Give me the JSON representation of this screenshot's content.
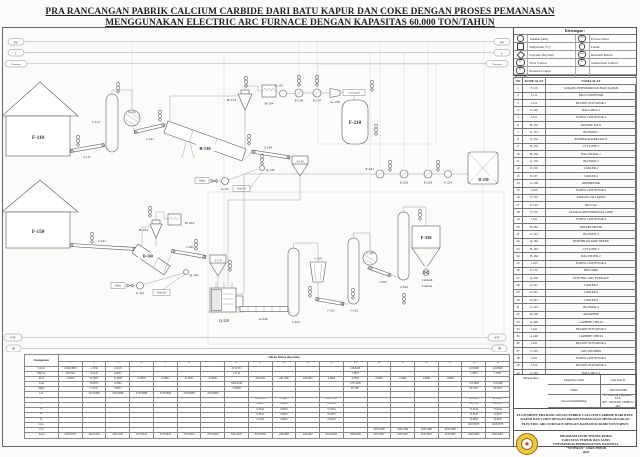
{
  "title": {
    "line1": "PRA RANCANGAN PABRIK CALCIUM CARBIDE DARI BATU KAPUR DAN COKE DENGAN PROSES PEMANASAN",
    "line2": "MENGGUNAKAN ELECTRIC ARC FURNACE DENGAN KAPASITAS 60.000 TON/TAHUN"
  },
  "colors": {
    "paper": "#fbfbfa",
    "line": "#555555",
    "logo_yellow": "#f3c63a",
    "logo_red": "#c23b2a"
  },
  "legend": {
    "title": "Keterangan :",
    "rows": [
      {
        "left_symbol": "circle",
        "left_label": "Tekanan (atm)",
        "right_code": "PW",
        "right_label": "Process Water"
      },
      {
        "left_symbol": "square",
        "left_label": "Temperatur (°C)",
        "right_code": "L",
        "right_label": "Listrik"
      },
      {
        "left_symbol": "diamond",
        "left_label": "Laju Alir (Kg/Jam)",
        "right_code": "DR",
        "right_label": "Dowterm Return"
      },
      {
        "left_code": "FC",
        "left_label": "Flow Control",
        "right_code": "TC",
        "right_label": "Temperature Control"
      },
      {
        "left_code": "PC",
        "left_label": "Pressure Control",
        "right_code": "",
        "right_label": ""
      },
      {
        "left_code": "WTP",
        "left_label": "Water Treatment Process",
        "right_code": "",
        "right_label": ""
      }
    ]
  },
  "equipment_table": {
    "headers": [
      "NO",
      "KODE ALAT",
      "NAMA ALAT"
    ],
    "rows": [
      [
        "1",
        "F-110",
        "GUDANG PENYIMPANAN BATU KAPUR"
      ],
      [
        "2",
        "J-111",
        "BELT CONVEYOR"
      ],
      [
        "3",
        "J-112",
        "BUCKET ELEVATOR-1"
      ],
      [
        "4",
        "C-120",
        "BALL MILL-1"
      ],
      [
        "5",
        "J-121",
        "SCREW CONVEYOR-1"
      ],
      [
        "6",
        "B-130",
        "ROTARY KILN"
      ],
      [
        "7",
        "G-131",
        "BLOWER-1"
      ],
      [
        "8",
        "Q-132",
        "BURNER ROTARY KILN"
      ],
      [
        "9",
        "H-133",
        "CYCLONE-1"
      ],
      [
        "10",
        "H-134",
        "BAG FILTER-1"
      ],
      [
        "11",
        "G-135",
        "BLOWER-2"
      ],
      [
        "12",
        "E-136",
        "COOLER-1"
      ],
      [
        "13",
        "E-137",
        "COOLER-2"
      ],
      [
        "14",
        "G-138",
        "KOMPRESOR"
      ],
      [
        "15",
        "J-139",
        "SCREW CONVEYOR-2"
      ],
      [
        "16",
        "F-210",
        "TANGKI CO2 LIQUID"
      ],
      [
        "17",
        "F-140",
        "BIN CaO"
      ],
      [
        "18",
        "F-150",
        "GUDANG PENYIMPANAN COKE"
      ],
      [
        "19",
        "J-141",
        "SCREW CONVEYOR-3"
      ],
      [
        "20",
        "B-160",
        "ROTARY DRYER"
      ],
      [
        "21",
        "G-161",
        "BLOWER-3"
      ],
      [
        "22",
        "Q-162",
        "BURNER ROTARY DRYER"
      ],
      [
        "23",
        "H-163",
        "CYCLONE-2"
      ],
      [
        "24",
        "H-164",
        "BAG FILTER-2"
      ],
      [
        "25",
        "J-165",
        "SCREW CONVEYOR-4"
      ],
      [
        "26",
        "F-170",
        "BIN COKE"
      ],
      [
        "27",
        "Q-220",
        "ELECTRIC ARC FURNACE"
      ],
      [
        "28",
        "E-221",
        "COOLER-3"
      ],
      [
        "29",
        "E-222",
        "COOLER-4"
      ],
      [
        "30",
        "E-223",
        "COOLER-5"
      ],
      [
        "31",
        "G-224",
        "BLOWER-4"
      ],
      [
        "32",
        "D-230",
        "ABSORBER"
      ],
      [
        "33",
        "A-240",
        "CARBIDE CHILLS"
      ],
      [
        "34",
        "J-241",
        "BUCKET ELEVATOR-2"
      ],
      [
        "35",
        "A-240",
        "CARBIDE CHILLS"
      ],
      [
        "36",
        "J-241",
        "BUCKET ELEVATOR-2"
      ],
      [
        "37",
        "C-310",
        "JAW CRUSHER"
      ],
      [
        "38",
        "J-311",
        "SCREW CONVEYOR-5"
      ],
      [
        "39",
        "J-312",
        "BUCKET ELEVATOR-3"
      ],
      [
        "40",
        "C-320",
        "BALL MILL-2"
      ],
      [
        "41",
        "J-321",
        "SCREW CONVEYOR-6"
      ],
      [
        "42",
        "J-322",
        "BUCKET ELEVATOR-4"
      ],
      [
        "43",
        "F-330",
        "SILO PENYIMPANAN CaC2"
      ]
    ]
  },
  "title_block": {
    "digambar_label": "Digambar Oleh",
    "digambar_value": "Ade Nandy",
    "mengetahui": "Mengetahui",
    "npm_label": "NPM",
    "npm_value": "20031010088",
    "dosen_label": "Dosen Pembimbing",
    "dosen_value": "Ir. Caecilia Pujiastuti, M.T.",
    "dosen_nip": "NIP. 19630305 198803 2 001",
    "flowsheet_caption": "FLOWSHEET PRA RANCANGAN PABRIK CALCIUM CARBIDE DARI BATU KAPUR DAN COKE DENGAN PROSES PEMANASAN MENGGUNAKAN ELECTRIC ARC FURNACE DENGAN KAPASITAS 60.000 TON/TAHUN",
    "institution": {
      "line1": "PROGRAM STUDI TEKNIK KIMIA",
      "line2": "FAKULTAS TEKNIK DAN SAINS",
      "line3": "UNIVERSITAS PEMBANGUNAN NASIONAL",
      "line4": "\"VETERAN\" JAWA TIMUR",
      "line5": "2023"
    }
  },
  "stream_table": {
    "corner_header": "Komponen",
    "title": "Aliran Massa (Kg/Jam)",
    "columns": [
      "1",
      "2",
      "3",
      "4",
      "5",
      "6",
      "7",
      "8",
      "9",
      "10",
      "11",
      "12",
      "13",
      "14",
      "15",
      "16",
      "17",
      "18",
      "19"
    ],
    "rows": [
      {
        "name": "CaCO₃",
        "values": [
          "10966.7858",
          "2.1939",
          "0.8218",
          "",
          "",
          "",
          "",
          "213.9131",
          "",
          "",
          "",
          "",
          "218.8948",
          "",
          "",
          "",
          "",
          "218.8948",
          "218.8948"
        ]
      },
      {
        "name": "MgCO₃",
        "values": [
          "89.2744",
          "0.8129",
          "0.0003",
          "",
          "",
          "",
          "",
          "1.3714",
          "",
          "",
          "",
          "",
          "1.3853",
          "",
          "",
          "",
          "",
          "1.3853",
          "1.3853"
        ]
      },
      {
        "name": "H₂O",
        "values": [
          "21.9935",
          "21.9935",
          "21.9935",
          "21.9935",
          "21.9935",
          "21.9935",
          "21.9935",
          "",
          "246.1945",
          "246.1940",
          "246.1940",
          "2.0909",
          "2.0909",
          "2.0909",
          "2.0909",
          "2.0909",
          "2.0909",
          "",
          ""
        ]
      },
      {
        "name": "CaO",
        "values": [
          "",
          "59.2670",
          "4.7984",
          "",
          "",
          "",
          "",
          "5924.6549",
          "",
          "",
          "",
          "",
          "7181.1608",
          "",
          "",
          "",
          "",
          "718.1608",
          "718.1608"
        ]
      },
      {
        "name": "MgO",
        "values": [
          "",
          "0.3233",
          "0.0013",
          "",
          "",
          "",
          "",
          "51.0843",
          "",
          "",
          "",
          "",
          "93.3281",
          "",
          "",
          "",
          "",
          "93.3281",
          "93.3281"
        ]
      },
      {
        "name": "CO₂",
        "values": [
          "",
          "4733.6688",
          "4733.6688",
          "4733.6688",
          "4733.6688",
          "4733.6688",
          "4733.6688",
          "",
          "",
          "",
          "",
          "",
          "",
          "",
          "",
          "",
          "",
          "",
          ""
        ]
      },
      {
        "name": "C",
        "values": [
          "",
          "",
          "",
          "",
          "",
          "",
          "",
          "",
          "5858.4718",
          "0.3847",
          "",
          "5847.1783",
          "",
          "",
          "",
          "",
          "",
          "603.8633",
          "603.8633"
        ]
      },
      {
        "name": "S",
        "values": [
          "",
          "",
          "",
          "",
          "",
          "",
          "",
          "",
          "6.2927",
          "0.0029",
          "",
          "29.2728",
          "",
          "",
          "",
          "",
          "",
          "29.2728",
          "29.2728"
        ]
      },
      {
        "name": "H₂",
        "values": [
          "",
          "",
          "",
          "",
          "",
          "",
          "",
          "",
          "9.3344",
          "0.0034",
          "",
          "57.6534",
          "",
          "",
          "",
          "",
          "",
          "57.6534",
          "57.6534"
        ]
      },
      {
        "name": "O₂",
        "values": [
          "",
          "",
          "",
          "",
          "",
          "",
          "",
          "",
          "9.3341",
          "0.0033",
          "",
          "55.6537",
          "",
          "",
          "",
          "",
          "",
          "55.6537",
          "55.6537"
        ]
      },
      {
        "name": "N₂",
        "values": [
          "",
          "",
          "",
          "",
          "",
          "",
          "",
          "",
          "6.2109",
          "0.0023",
          "",
          "23.0903",
          "",
          "",
          "",
          "",
          "",
          "23.0903",
          "23.0903"
        ]
      },
      {
        "name": "CaC₂",
        "values": [
          "",
          "",
          "",
          "",
          "",
          "",
          "",
          "",
          "",
          "",
          "",
          "",
          "",
          "",
          "",
          "",
          "",
          "6618.6978",
          "6618.6978"
        ]
      },
      {
        "name": "CO",
        "values": [
          "",
          "",
          "",
          "",
          "",
          "",
          "",
          "",
          "",
          "",
          "",
          "",
          "",
          "2433.1898",
          "2433.1898",
          "2433.1898",
          "2433.1898",
          "",
          ""
        ]
      },
      {
        "name": "Total",
        "values": [
          "11078.0537",
          "4818.2594",
          "4761.2841",
          "4755.6623",
          "4755.6623",
          "4755.6623",
          "4755.6623",
          "6191.0237",
          "6135.8384",
          "246.5906",
          "246.1940",
          "6014.9394",
          "7496.8599",
          "2435.2807",
          "2435.2807",
          "2435.2807",
          "2435.2807",
          "8420.0003",
          "8420.0003"
        ]
      }
    ]
  },
  "diagram": {
    "utilities": {
      "pw": "PW",
      "listrik": "L",
      "dowterm": "Dowterm",
      "wtp": "WTP",
      "dr": "DR"
    },
    "annotations": {
      "udara": "Udara",
      "fuel_oil": "Fuel Oil",
      "co2_liquid": "CO2 Liquid",
      "calcium": "Calcium",
      "carbide": "Carbide"
    },
    "labels": {
      "f110": "F-110",
      "j111": "J-111",
      "j112": "J-112",
      "c120": "C-120",
      "j121": "J-121",
      "b130": "B-130",
      "g131": "G-131",
      "q132": "Q-132",
      "h133": "H-133",
      "h134": "H-134",
      "g135": "G-135",
      "e136": "E-136",
      "e137": "E-137",
      "g138": "G-138",
      "f210": "F-210",
      "j139": "J-139",
      "f140": "F-140",
      "f150": "F-150",
      "j141": "J-141",
      "b160": "B-160",
      "g161": "G-161",
      "q162": "Q-162",
      "h163": "H-163",
      "h164": "H-164",
      "j165": "J-165",
      "f170": "F-170",
      "q220": "Q-220",
      "e221": "E-221",
      "e222": "E-222",
      "e223": "E-223",
      "g224": "G-224",
      "d230": "D-230",
      "a240": "A-240",
      "j241": "J-241",
      "c310": "C-310",
      "j311": "J-311",
      "j312": "J-312",
      "c320": "C-320",
      "j321": "J-321",
      "j322": "J-322",
      "f330": "F-330"
    }
  }
}
